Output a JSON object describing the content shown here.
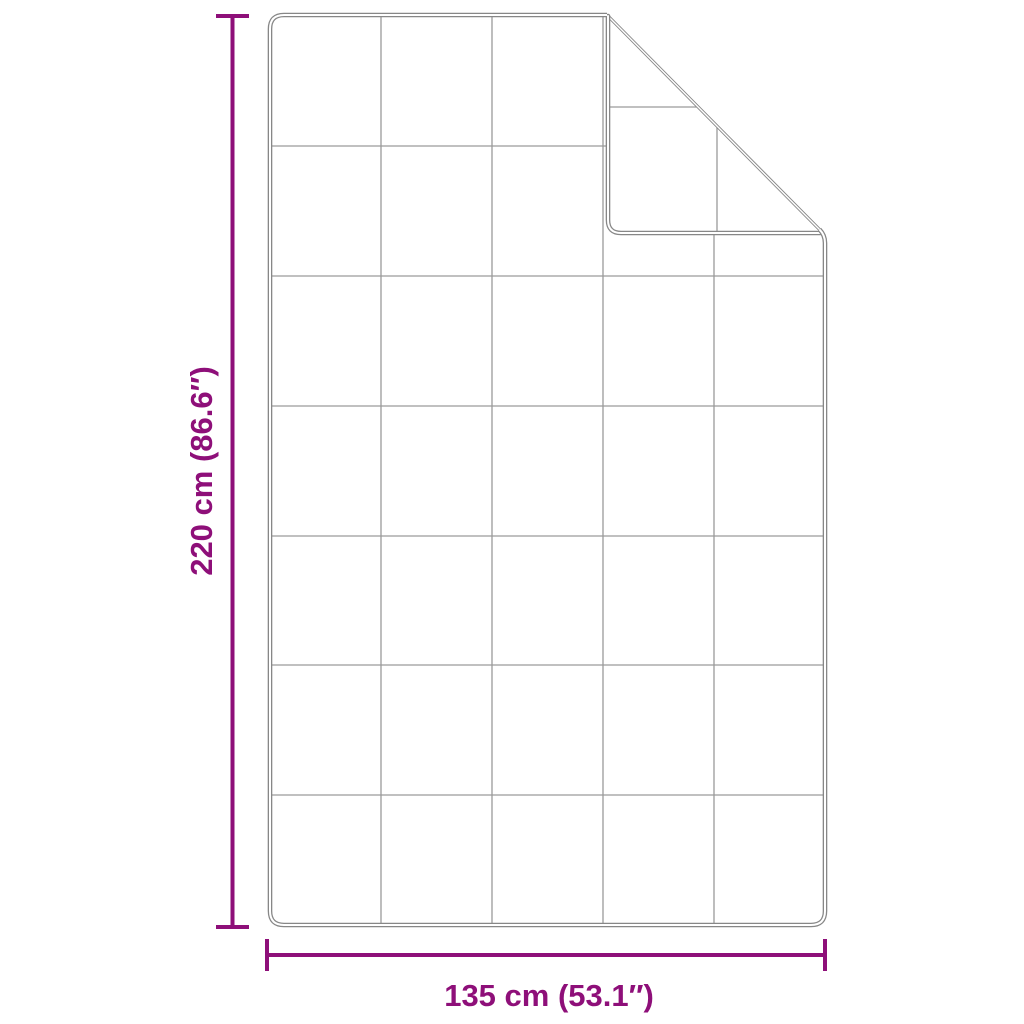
{
  "diagram": {
    "kind": "product-dimension-diagram",
    "subject": "quilted blanket with folded top-right corner",
    "grid": {
      "columns": 5,
      "rows": 7
    },
    "colors": {
      "accent": "#8E0F79",
      "outline": "#878787",
      "grid_line": "#9A9A9A",
      "background": "#FFFFFF"
    },
    "dimensions": {
      "height": {
        "label": "220 cm (86.6″)",
        "cm": "220",
        "inches": "86.6"
      },
      "width": {
        "label": "135 cm (53.1″)",
        "cm": "135",
        "inches": "53.1"
      }
    }
  }
}
